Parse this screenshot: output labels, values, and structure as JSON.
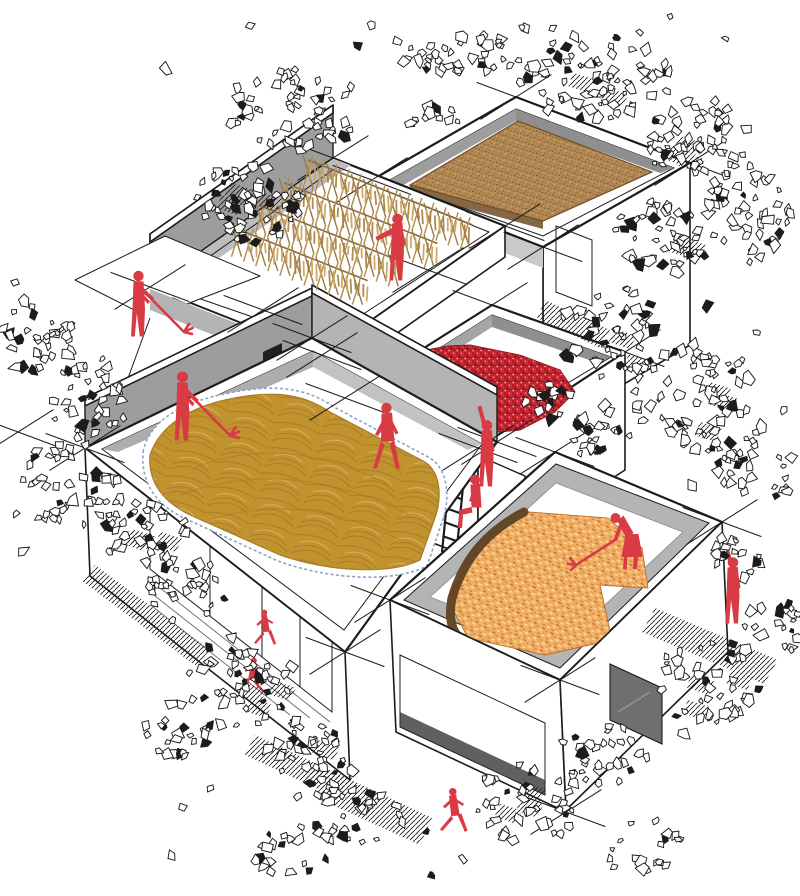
{
  "title": "Axonometric architectural illustration — rooftop crop drying in a village cluster",
  "palette": {
    "paper": "#ffffff",
    "ink": "#1c1c1c",
    "red": "#d93b44",
    "chili": "#c5242f",
    "chili_dark": "#8f1620",
    "grain": "#b38a55",
    "grain_dark": "#8a6436",
    "grain_deep": "#6e4d26",
    "gold": "#c1932f",
    "gold_dark": "#a87c28",
    "gold_light": "#d9b25c",
    "corn": "#f1b066",
    "corn_dark": "#d2883a",
    "corn_deep": "#b96f2a",
    "corn_light": "#fbdfae",
    "husk": "#5f4122",
    "wood": "#9b7b44",
    "wood_light": "#b08c50",
    "fringe": "#c9a35e",
    "gray_wall": "#9d9d9d",
    "gray_mid": "#b4b4b4",
    "gray_light": "#c9c9c9",
    "glass": "#a2a2a2",
    "tarp": "#8aa4c8",
    "win_dark": "#6f6f6f"
  },
  "scene": {
    "buildings": [
      {
        "id": "b1",
        "roof_content": "brown-grain-drying-bed"
      },
      {
        "id": "b2",
        "roof_content": "a-frame-drying-racks"
      },
      {
        "id": "b3",
        "roof_content": "red-chilies-drying"
      },
      {
        "id": "b4",
        "roof_content": "golden-grain-on-tarp"
      },
      {
        "id": "b5",
        "roof_content": "corn-cobs-drying"
      }
    ],
    "figures": [
      {
        "pose": "raking",
        "where": "upper-left-terrace"
      },
      {
        "pose": "pointing",
        "where": "rack-terrace"
      },
      {
        "pose": "raised-arm",
        "where": "chili-roof-edge"
      },
      {
        "pose": "sitting",
        "where": "ladder"
      },
      {
        "pose": "raking",
        "where": "golden-grain-roof"
      },
      {
        "pose": "walking",
        "where": "roof-edge"
      },
      {
        "pose": "bending-raking-woman",
        "where": "corn-roof"
      },
      {
        "pose": "raised-arm",
        "where": "right-ground"
      },
      {
        "pose": "running",
        "where": "bottom-ground"
      },
      {
        "pose": "child-running",
        "where": "front-of-glass-wall"
      },
      {
        "pose": "child-running",
        "where": "front-of-glass-wall"
      }
    ],
    "seed": 7,
    "xmarks": [
      [
        516,
        97
      ],
      [
        690,
        163
      ],
      [
        543,
        247
      ],
      [
        372,
        180
      ],
      [
        333,
        158
      ],
      [
        150,
        287
      ],
      [
        322,
        355
      ],
      [
        505,
        226
      ],
      [
        492,
        305
      ],
      [
        625,
        352
      ],
      [
        478,
        448
      ],
      [
        345,
        398
      ],
      [
        85,
        448
      ],
      [
        312,
        338
      ],
      [
        497,
        442
      ],
      [
        345,
        652
      ],
      [
        18,
        432
      ],
      [
        555,
        452
      ],
      [
        722,
        522
      ],
      [
        560,
        680
      ],
      [
        390,
        600
      ],
      [
        566,
        812
      ],
      [
        428,
        270
      ],
      [
        263,
        310
      ]
    ],
    "racks": {
      "rows": 4,
      "row_t": [
        42,
        78,
        114,
        150
      ],
      "origin": [
        333,
        158
      ],
      "u": [
        0.93,
        0.368
      ],
      "v": [
        -0.817,
        0.576
      ],
      "row_len": [
        177,
        165,
        153,
        141
      ],
      "stick_gap": 13
    },
    "foliage_clusters": [
      [
        295,
        110,
        70,
        42,
        55,
        0
      ],
      [
        425,
        62,
        32,
        20,
        16,
        0
      ],
      [
        248,
        205,
        55,
        42,
        60,
        1
      ],
      [
        478,
        56,
        36,
        24,
        20,
        0
      ],
      [
        592,
        78,
        80,
        45,
        80,
        1
      ],
      [
        693,
        138,
        55,
        40,
        55,
        1
      ],
      [
        748,
        212,
        48,
        48,
        50,
        0
      ],
      [
        658,
        238,
        45,
        38,
        45,
        1
      ],
      [
        612,
        332,
        55,
        45,
        50,
        1
      ],
      [
        695,
        398,
        65,
        55,
        65,
        1
      ],
      [
        757,
        472,
        40,
        35,
        30,
        0
      ],
      [
        603,
        432,
        38,
        28,
        25,
        0
      ],
      [
        38,
        338,
        40,
        40,
        32,
        0
      ],
      [
        92,
        397,
        45,
        40,
        38,
        0
      ],
      [
        68,
        483,
        50,
        45,
        42,
        0
      ],
      [
        142,
        528,
        45,
        40,
        40,
        1
      ],
      [
        188,
        592,
        40,
        35,
        32,
        0
      ],
      [
        242,
        682,
        55,
        45,
        50,
        1
      ],
      [
        308,
        758,
        50,
        40,
        42,
        1
      ],
      [
        178,
        732,
        35,
        30,
        22,
        0
      ],
      [
        358,
        818,
        45,
        35,
        30,
        0
      ],
      [
        292,
        852,
        40,
        28,
        20,
        0
      ],
      [
        528,
        802,
        55,
        40,
        40,
        1
      ],
      [
        602,
        757,
        45,
        35,
        30,
        0
      ],
      [
        642,
        848,
        40,
        28,
        20,
        0
      ],
      [
        708,
        682,
        55,
        45,
        45,
        1
      ],
      [
        772,
        628,
        35,
        30,
        20,
        0
      ],
      [
        545,
        398,
        28,
        22,
        16,
        0
      ],
      [
        435,
        120,
        26,
        18,
        12,
        0
      ],
      [
        740,
        555,
        30,
        24,
        16,
        0
      ]
    ],
    "stray_leaf_bands": [
      [
        60,
        760,
        15,
        95,
        14
      ],
      [
        690,
        790,
        250,
        520,
        10
      ],
      [
        0,
        80,
        280,
        560,
        8
      ],
      [
        150,
        700,
        700,
        880,
        12
      ]
    ]
  }
}
